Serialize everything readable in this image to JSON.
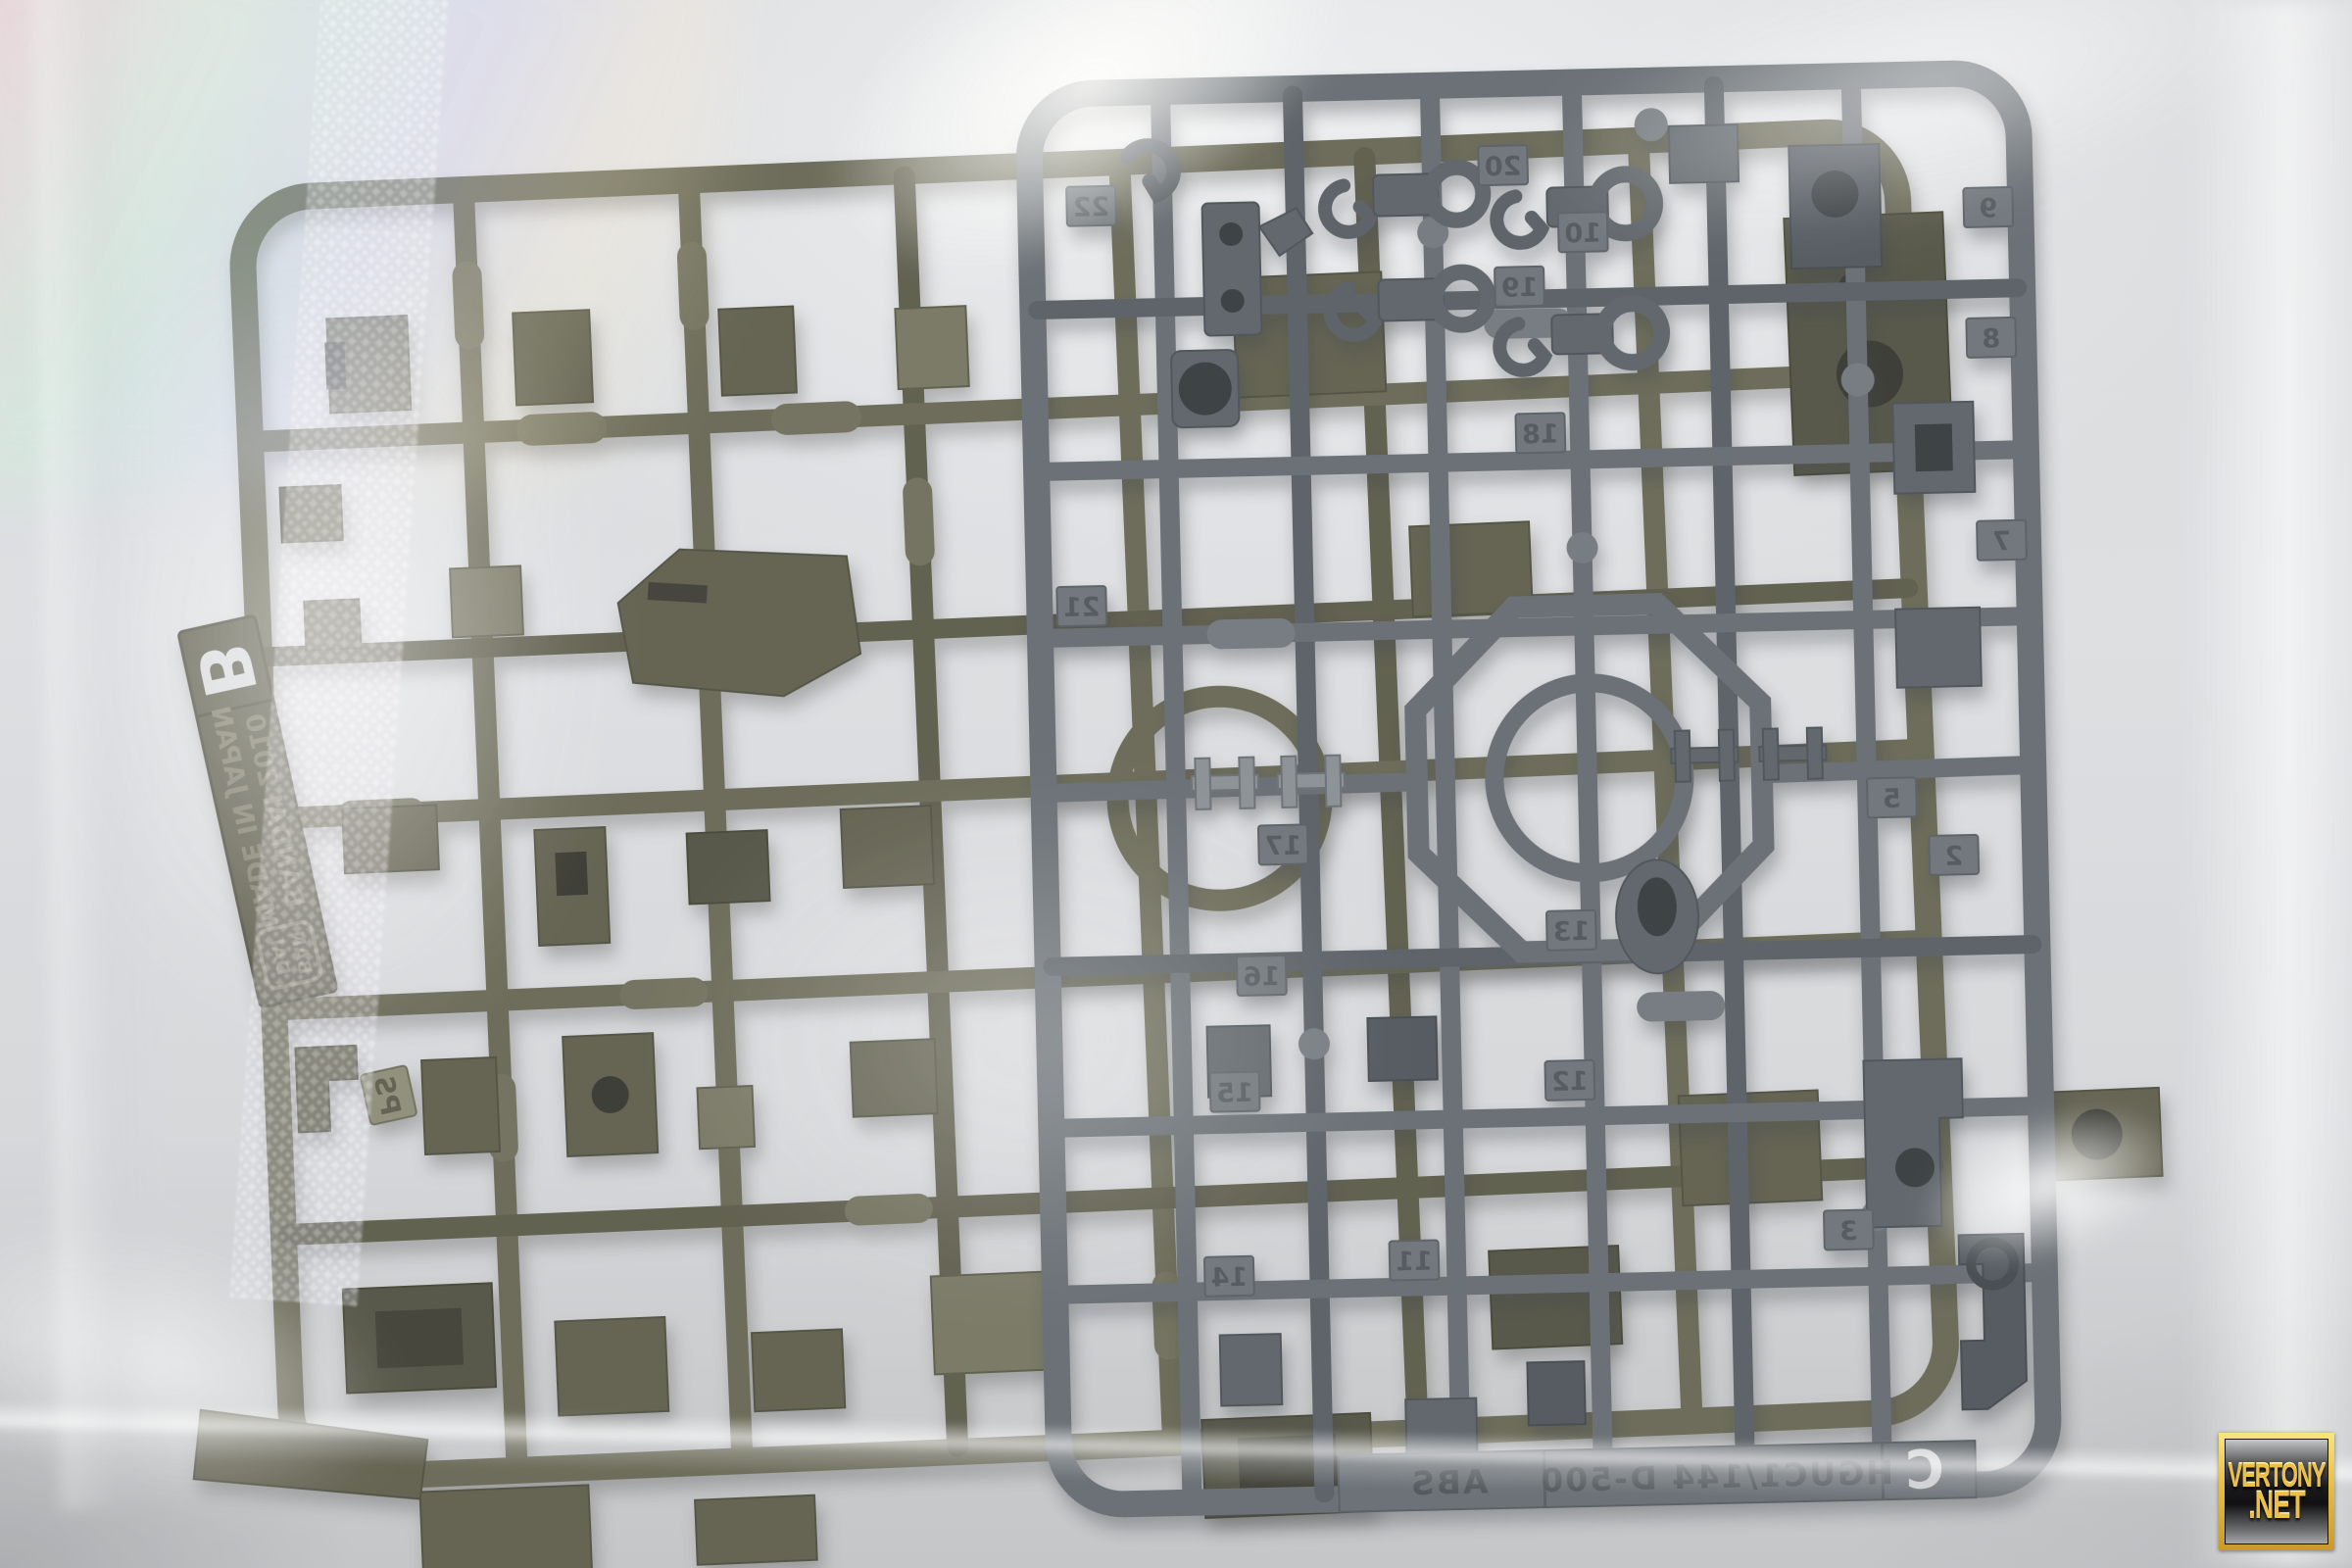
{
  "watermark": {
    "line1": "VERTONY",
    "line2": ".NET",
    "gold_color": "#eebf48"
  },
  "olive_sprue": {
    "color": "#5a5843",
    "tag_letter": "B",
    "maker_line1": "BANDAI 2010",
    "maker_line2": "MADE IN JAPAN",
    "logo_line1": "BAN",
    "logo_line2": "DAI",
    "material": "PS"
  },
  "grey_sprue": {
    "color": "#565c62",
    "tag_letter": "C",
    "marking": "HGUC1/144 D-500",
    "material": "ABS",
    "part_numbers": [
      "22",
      "21",
      "20",
      "19",
      "18",
      "17",
      "16",
      "15",
      "14",
      "13",
      "12",
      "11",
      "10",
      "9",
      "8",
      "7",
      "5",
      "3",
      "2"
    ]
  }
}
